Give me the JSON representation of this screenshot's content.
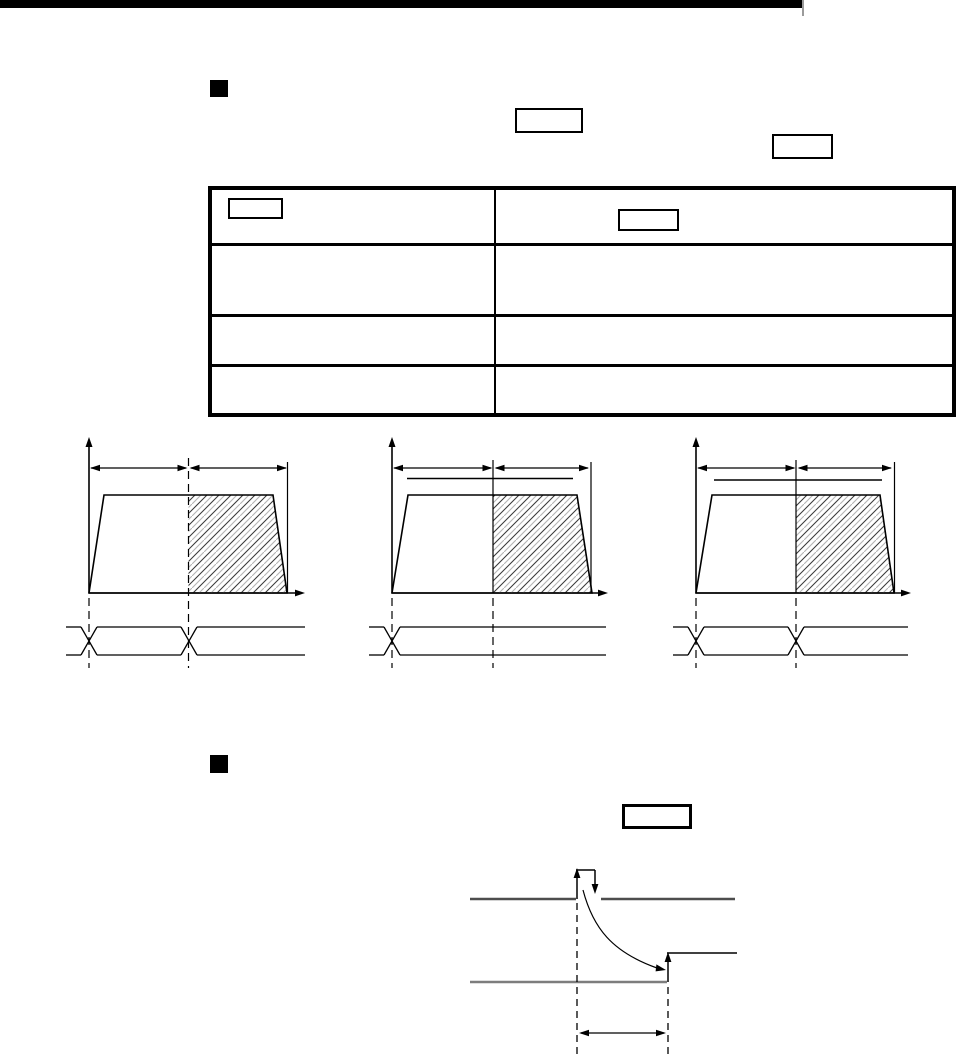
{
  "document": {
    "kind": "scanned manual page",
    "visible_text": ""
  },
  "colors": {
    "page_bg": "#ffffff",
    "ink": "#000000",
    "edge_tick": "#9b9b9b",
    "signal_dark_gray": "#4d4d4d",
    "signal_gray": "#7d7d7d",
    "hatch_line": "#3c3c3c",
    "hatch_line_light": "#b4b4b4"
  },
  "header": {
    "bar_label": ""
  },
  "section_1": {
    "marker": "filled-square-bullet",
    "inline_placeholder_boxes": [
      {
        "label": ""
      },
      {
        "label": ""
      }
    ]
  },
  "table": {
    "columns": 2,
    "header": {
      "col1_box_label": "",
      "col2_box_label": "",
      "col1_text": "",
      "col2_text": ""
    },
    "body_rows": [
      {
        "col1": "",
        "col2": ""
      },
      {
        "col1": "",
        "col2": ""
      },
      {
        "col1": "",
        "col2": ""
      }
    ]
  },
  "velocity_diagrams": [
    {
      "name": "profile-1",
      "span_arrows": 2,
      "hatched_second_half": true,
      "overline": false,
      "timing_crossovers": 2
    },
    {
      "name": "profile-2",
      "span_arrows": 2,
      "hatched_second_half": true,
      "overline": true,
      "timing_crossovers": 1
    },
    {
      "name": "profile-3",
      "span_arrows": 2,
      "hatched_second_half": true,
      "overline": true,
      "timing_crossovers": 2
    }
  ],
  "section_2": {
    "marker": "filled-square-bullet",
    "inline_placeholder_boxes": [
      {
        "label": ""
      }
    ]
  },
  "timing_diagram": {
    "pulse_on_upper_signal": true,
    "curved_cause_effect_arrow": true,
    "rising_edge_on_lower_signal": true,
    "interval_measure_arrow": true
  }
}
